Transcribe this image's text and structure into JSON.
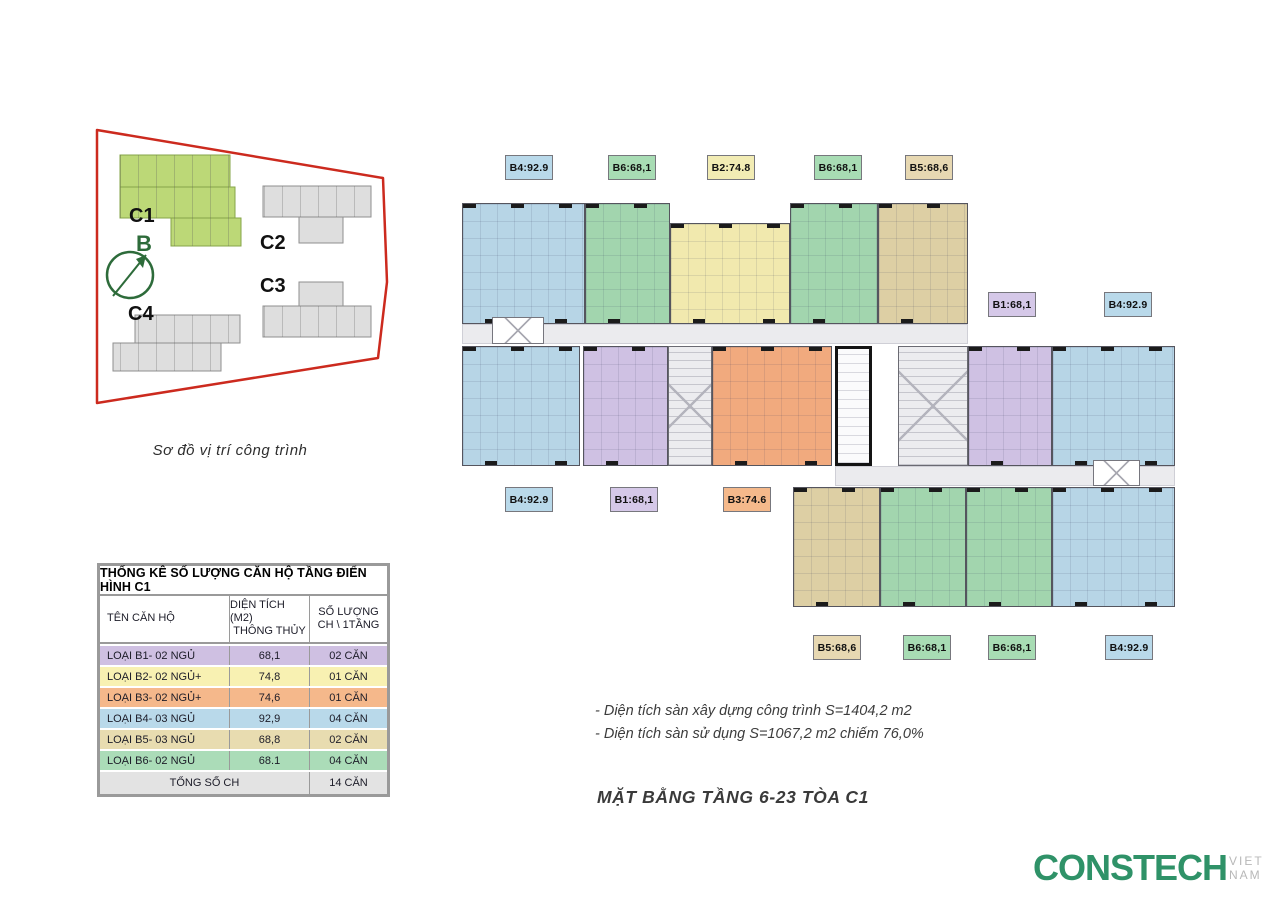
{
  "site_diagram": {
    "caption": "Sơ đồ vị trí công trình",
    "building_labels": {
      "c1": "C1",
      "c2": "C2",
      "c3": "C3",
      "c4": "C4"
    },
    "direction_label": "B"
  },
  "floor_plan": {
    "unit_labels": [
      {
        "id": "top-1",
        "text": "B4:92.9"
      },
      {
        "id": "top-2",
        "text": "B6:68,1"
      },
      {
        "id": "top-3",
        "text": "B2:74.8"
      },
      {
        "id": "top-4",
        "text": "B6:68,1"
      },
      {
        "id": "top-5",
        "text": "B5:68,6"
      },
      {
        "id": "right-1",
        "text": "B1:68,1"
      },
      {
        "id": "right-2",
        "text": "B4:92.9"
      },
      {
        "id": "mid-1",
        "text": "B4:92.9"
      },
      {
        "id": "mid-2",
        "text": "B1:68,1"
      },
      {
        "id": "mid-3",
        "text": "B3:74.6"
      },
      {
        "id": "bottom-1",
        "text": "B5:68,6"
      },
      {
        "id": "bottom-2",
        "text": "B6:68,1"
      },
      {
        "id": "bottom-3",
        "text": "B6:68,1"
      },
      {
        "id": "bottom-4",
        "text": "B4:92.9"
      }
    ]
  },
  "table": {
    "title": "THỐNG KÊ SỐ LƯỢNG CĂN HỘ TẦNG ĐIỂN HÌNH C1",
    "headers": {
      "name": "TÊN CĂN HỘ",
      "area_line1": "DIỆN TÍCH (M2)",
      "area_line2": "THÔNG THỦY",
      "count_line1": "SỐ LƯỢNG",
      "count_line2": "CH \\ 1TẦNG"
    },
    "rows": [
      {
        "name": "LOẠI B1- 02 NGỦ",
        "area": "68,1",
        "count": "02 CĂN"
      },
      {
        "name": "LOẠI B2- 02 NGỦ+",
        "area": "74,8",
        "count": "01 CĂN"
      },
      {
        "name": "LOẠI B3- 02 NGỦ+",
        "area": "74,6",
        "count": "01 CĂN"
      },
      {
        "name": "LOẠI B4- 03 NGỦ",
        "area": "92,9",
        "count": "04 CĂN"
      },
      {
        "name": "LOẠI B5- 03 NGỦ",
        "area": "68,8",
        "count": "02 CĂN"
      },
      {
        "name": "LOẠI B6- 02 NGỦ",
        "area": "68.1",
        "count": "04 CĂN"
      }
    ],
    "total": {
      "label": "TỔNG SỐ CH",
      "count": "14 CĂN"
    }
  },
  "notes": {
    "line1": "- Diện tích sàn xây dựng công trình S=1404,2 m2",
    "line2": "- Diện tích sàn sử dụng S=1067,2 m2 chiếm 76,0%"
  },
  "main_title": "MẶT BẰNG TẦNG 6-23 TÒA C1",
  "logo": {
    "name": "CONSTECH",
    "region": "VIET NAM"
  },
  "colors": {
    "unit_b1_purple": "#cfc1e3",
    "unit_b2_yellow": "#f1e9ae",
    "unit_b3_orange": "#f1aa7e",
    "unit_b4_blue": "#b7d5e6",
    "unit_b5_tan": "#ddcfa4",
    "unit_b6_green": "#a2d5ae",
    "site_boundary_red": "#cc2a1e",
    "building_c1_green": "#bcd877",
    "building_gray": "#dedede",
    "compass_green": "#2d6b3a",
    "logo_green": "#2f9268",
    "total_row_gray": "#e3e3e3"
  }
}
